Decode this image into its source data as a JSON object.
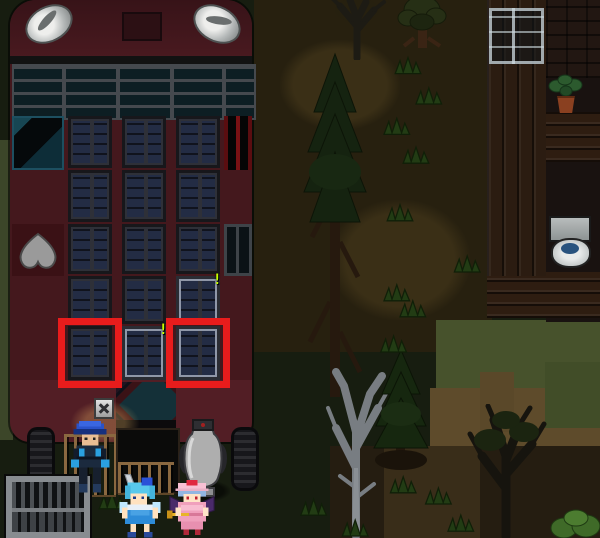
{
  "scene": {
    "type": "top-down pixel RPG map",
    "description": "Dark forest camp at night: a large dark-red bus with a grid of windows on the left, a wooden outhouse building with a toilet on the right, three character sprites near the bus entrance",
    "canvas": {
      "width": 600,
      "height": 538
    }
  },
  "colors": {
    "highlight_box": "#e81c1c",
    "alert_marker": "#c6ff00",
    "bus_body": "#44181d",
    "window_lit": "#6b81b5",
    "window_dark": "#232c44",
    "grass_dark": "#171d10",
    "grass_bright": "#47522c",
    "dirt": "#5e4b2b",
    "building_wood": "#2b1c11"
  },
  "bus": {
    "alert_symbol": "!",
    "window_grid": {
      "columns": 3,
      "rows": [
        {
          "row": 1,
          "left_tile": "emblem-flag-tile",
          "cells": [
            "dark",
            "dark",
            "dark"
          ],
          "right_tile": "red-black-panel"
        },
        {
          "row": 2,
          "cells": [
            "dark",
            "dark",
            "dark"
          ]
        },
        {
          "row": 3,
          "left_tile": "gray-heart-tile",
          "cells": [
            "dark",
            "dark",
            "dark"
          ],
          "right_tile": "black-panel"
        },
        {
          "row": 4,
          "cells": [
            "dark",
            "dark",
            "lit-with-alert"
          ]
        },
        {
          "row": 5,
          "cells": [
            "dark-highlighted-red-box",
            "lit-with-alert",
            "lit-highlighted-red-box"
          ]
        }
      ],
      "highlighted_windows": [
        {
          "row": 5,
          "col": 1
        },
        {
          "row": 5,
          "col": 3
        }
      ],
      "alert_windows": [
        {
          "row": 4,
          "col": 3
        },
        {
          "row": 5,
          "col": 2
        }
      ]
    },
    "props": [
      "headlight-left",
      "headlight-right",
      "roof-hatch",
      "windshield-grille",
      "sign-with-x",
      "striped-awning",
      "dark-entrance",
      "wooden-fence",
      "water-jug",
      "wheel-left",
      "wheel-right"
    ]
  },
  "characters": [
    {
      "id": "guard",
      "description": "soldier with blue cap and dark blue uniform standing by the fence",
      "position": "left of bus entrance"
    },
    {
      "id": "blue-haired-girl",
      "description": "girl with cyan hair, blue bow, ice wings, holding a sword",
      "position": "bottom center"
    },
    {
      "id": "pink-dressed-girl",
      "description": "girl in pink mob cap and pink dress with purple bat wings holding a gold rod",
      "position": "bottom center right"
    }
  ],
  "environment": {
    "building": {
      "walls": "dark wooden planks and logs",
      "contents": [
        "glass-window",
        "potted-plant",
        "toilet"
      ]
    },
    "objects": [
      "metal-crate"
    ],
    "trees": [
      "dead-tree-top",
      "leafy-tree-top",
      "tall-pine-center",
      "dead-gray-tree-bottom",
      "pine-tree-bottom",
      "dark-tree-bottom-right",
      "green-bush-corner"
    ],
    "ground": [
      "dark-grass",
      "dirt-path",
      "bright-grass-patch",
      "tan-dirt-patch",
      "grass-tufts"
    ]
  }
}
